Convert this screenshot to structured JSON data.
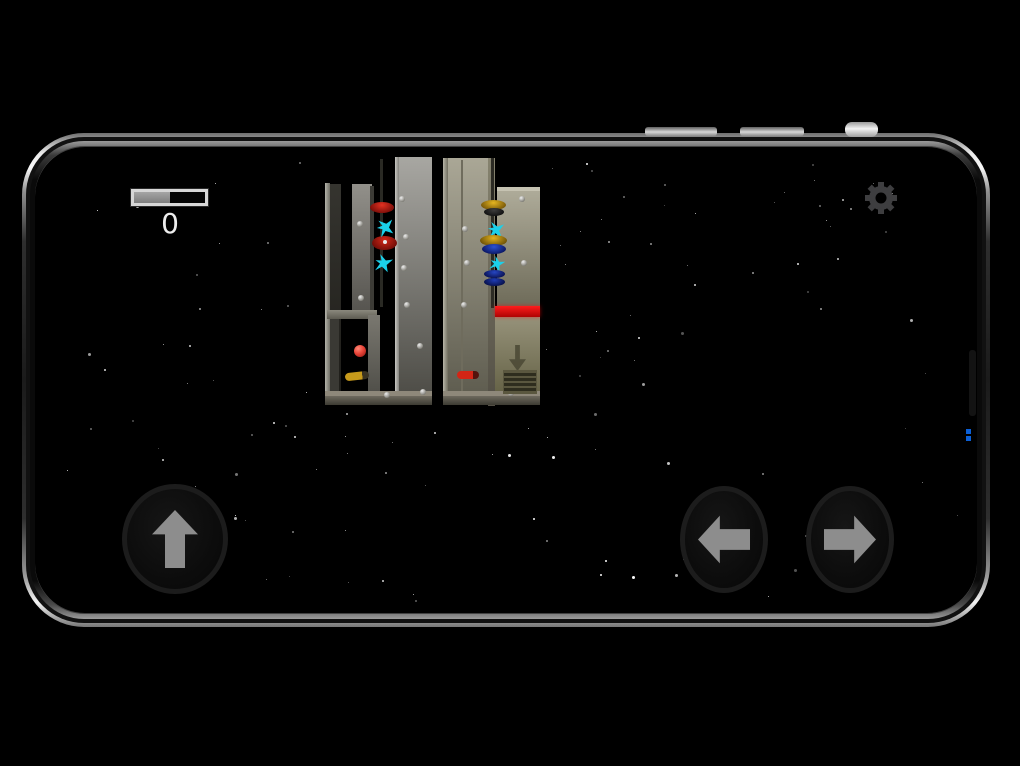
{
  "hud": {
    "score": "0",
    "progress_fill_ratio": 0.5,
    "gear_color": "#3e3e40",
    "icons": [
      "settings-gear-icon"
    ]
  },
  "controls": {
    "arrow_color": "#8d8d8d",
    "buttons": [
      {
        "name": "jump-up-button",
        "icon": "up-arrow-icon"
      },
      {
        "name": "move-left-button",
        "icon": "left-arrow-icon"
      },
      {
        "name": "move-right-button",
        "icon": "right-arrow-icon"
      }
    ]
  },
  "phone": {
    "top_buttons": [
      {
        "x": 645,
        "y": 127,
        "w": 72,
        "h": 9,
        "r": 3,
        "bright": false,
        "name": "volume-button-1"
      },
      {
        "x": 740,
        "y": 127,
        "w": 64,
        "h": 9,
        "r": 3,
        "bright": false,
        "name": "volume-button-2"
      },
      {
        "x": 845,
        "y": 122,
        "w": 33,
        "h": 15,
        "r": 7,
        "bright": true,
        "name": "power-button"
      }
    ],
    "antenna_strip": {
      "x": 969,
      "y": 350,
      "w": 7,
      "h": 66
    },
    "blue_glyph": {
      "x": 966,
      "y": 429,
      "w": 6,
      "sq": 5,
      "gap": 2
    }
  },
  "stars": {
    "seed": 1337,
    "count": 150,
    "area": {
      "x": 52,
      "y": 158,
      "w": 906,
      "h": 448
    },
    "exclude": {
      "x": 318,
      "y": 154,
      "w": 228,
      "h": 252
    }
  },
  "scene": {
    "towers": [
      {
        "name": "left-tower",
        "panels": [
          {
            "x": 325,
            "y": 183,
            "w": 5,
            "h": 219,
            "bg": "lgx:#b3b2a9,#6f6e65"
          },
          {
            "x": 330,
            "y": 184,
            "w": 11,
            "h": 218,
            "bg": "lg:#35342f,#1d1c18"
          },
          {
            "x": 352,
            "y": 184,
            "w": 20,
            "h": 126,
            "bg": "lg:#92908a,#575550"
          },
          {
            "x": 370,
            "y": 186,
            "w": 4,
            "h": 124,
            "bg": "#3c3b36"
          },
          {
            "x": 380,
            "y": 159,
            "w": 3,
            "h": 148,
            "bg": "#2a2a24"
          },
          {
            "x": 395,
            "y": 157,
            "w": 37,
            "h": 245,
            "bg": "lg:#a8a7a2,#4b4a44"
          },
          {
            "x": 395,
            "y": 157,
            "w": 4,
            "h": 245,
            "bg": "lgx:#c8c7c2,#83827d"
          },
          {
            "x": 327,
            "y": 310,
            "w": 50,
            "h": 9,
            "bg": "lg:#8b897d,#5e5c52"
          },
          {
            "x": 330,
            "y": 319,
            "w": 9,
            "h": 72,
            "bg": "#3a3934"
          },
          {
            "x": 368,
            "y": 315,
            "w": 12,
            "h": 76,
            "bg": "lg:#7a7870,#51504a"
          },
          {
            "x": 325,
            "y": 391,
            "w": 107,
            "h": 6,
            "bg": "#8e887a"
          },
          {
            "x": 325,
            "y": 396,
            "w": 107,
            "h": 9,
            "bg": "lg:#6e6a5e,#3d3b33"
          }
        ],
        "rivets": [
          [
            357,
            221
          ],
          [
            399,
            196
          ],
          [
            403,
            234
          ],
          [
            401,
            265
          ],
          [
            404,
            302
          ],
          [
            358,
            295
          ],
          [
            417,
            343
          ],
          [
            420,
            389
          ],
          [
            384,
            392
          ]
        ],
        "objects": [
          {
            "t": "disc",
            "x": 370,
            "y": 202,
            "w": 24,
            "h": 11,
            "c1": "#e23222",
            "c2": "#780d08"
          },
          {
            "t": "disc",
            "x": 372,
            "y": 236,
            "w": 25,
            "h": 14,
            "c1": "#d42818",
            "c2": "#6f0c07",
            "dot": true
          },
          {
            "t": "spark",
            "x": 377,
            "y": 219,
            "s": 17,
            "rot": -15,
            "c": "#1bd0ea"
          },
          {
            "t": "spark",
            "x": 375,
            "y": 255,
            "s": 17,
            "rot": 12,
            "c": "#1bd0ea"
          },
          {
            "t": "ball",
            "x": 354,
            "y": 345,
            "d": 12,
            "c1": "#e84438",
            "c2": "#8a1410"
          },
          {
            "t": "pill",
            "x": 345,
            "y": 372,
            "w": 24,
            "h": 8,
            "c": "#c79a1b",
            "tip": "#3a3322",
            "rot": -6
          }
        ]
      },
      {
        "name": "right-tower",
        "panels": [
          {
            "x": 443,
            "y": 158,
            "w": 5,
            "h": 242,
            "bg": "lgx:#b8b5a8,#716e5f"
          },
          {
            "x": 448,
            "y": 158,
            "w": 42,
            "h": 242,
            "bg": "lg:#aaa796,#5d5b4e"
          },
          {
            "x": 461,
            "y": 160,
            "w": 2,
            "h": 238,
            "bg": "#6f6c5d"
          },
          {
            "x": 488,
            "y": 158,
            "w": 7,
            "h": 248,
            "bg": "lg:#86836f,#534f45"
          },
          {
            "x": 491,
            "y": 158,
            "w": 3,
            "h": 150,
            "bg": "#2c2b24"
          },
          {
            "x": 497,
            "y": 187,
            "w": 43,
            "h": 120,
            "bg": "lg:#b0ad9b,#6e6b59"
          },
          {
            "x": 497,
            "y": 187,
            "w": 43,
            "h": 4,
            "bg": "#c6c3b2"
          },
          {
            "x": 495,
            "y": 317,
            "w": 45,
            "h": 74,
            "bg": "lg:#96927a,#676448"
          },
          {
            "x": 443,
            "y": 391,
            "w": 97,
            "h": 6,
            "bg": "#8e887a"
          },
          {
            "x": 443,
            "y": 396,
            "w": 97,
            "h": 9,
            "bg": "lg:#6e6a5e,#3d3b33"
          }
        ],
        "rivets": [
          [
            462,
            226
          ],
          [
            464,
            260
          ],
          [
            461,
            302
          ],
          [
            519,
            196
          ],
          [
            521,
            260
          ],
          [
            508,
            390
          ]
        ],
        "objects": [
          {
            "t": "disc",
            "x": 481,
            "y": 200,
            "w": 25,
            "h": 10,
            "c1": "#e5b520",
            "c2": "#765608"
          },
          {
            "t": "disc",
            "x": 484,
            "y": 208,
            "w": 20,
            "h": 8,
            "c1": "#3c3c3c",
            "c2": "#101010"
          },
          {
            "t": "spark",
            "x": 488,
            "y": 222,
            "s": 16,
            "rot": 0,
            "c": "#1bd0ea"
          },
          {
            "t": "disc",
            "x": 480,
            "y": 235,
            "w": 27,
            "h": 11,
            "c1": "#e2b21e",
            "c2": "#6d5106"
          },
          {
            "t": "disc",
            "x": 482,
            "y": 244,
            "w": 24,
            "h": 10,
            "c1": "#2c52d2",
            "c2": "#0a1560"
          },
          {
            "t": "spark",
            "x": 490,
            "y": 257,
            "s": 14,
            "rot": 20,
            "c": "#1bd0ea"
          },
          {
            "t": "disc",
            "x": 484,
            "y": 270,
            "w": 21,
            "h": 8,
            "c1": "#2646c2",
            "c2": "#0a1252"
          },
          {
            "t": "disc",
            "x": 484,
            "y": 278,
            "w": 21,
            "h": 8,
            "c1": "#1e3cb4",
            "c2": "#081048"
          },
          {
            "t": "bar",
            "x": 495,
            "y": 306,
            "w": 45,
            "h": 11
          },
          {
            "t": "downarrow",
            "x": 509,
            "y": 345,
            "w": 17,
            "h": 26,
            "c": "#4a4834"
          },
          {
            "t": "grate",
            "x": 503,
            "y": 370,
            "w": 32,
            "h": 22,
            "c": "#2e2d1e",
            "line": "#5a573f"
          },
          {
            "t": "pill",
            "x": 457,
            "y": 371,
            "w": 22,
            "h": 8,
            "c": "#d32515",
            "tip": "#55130c",
            "rot": 0
          }
        ]
      }
    ]
  }
}
